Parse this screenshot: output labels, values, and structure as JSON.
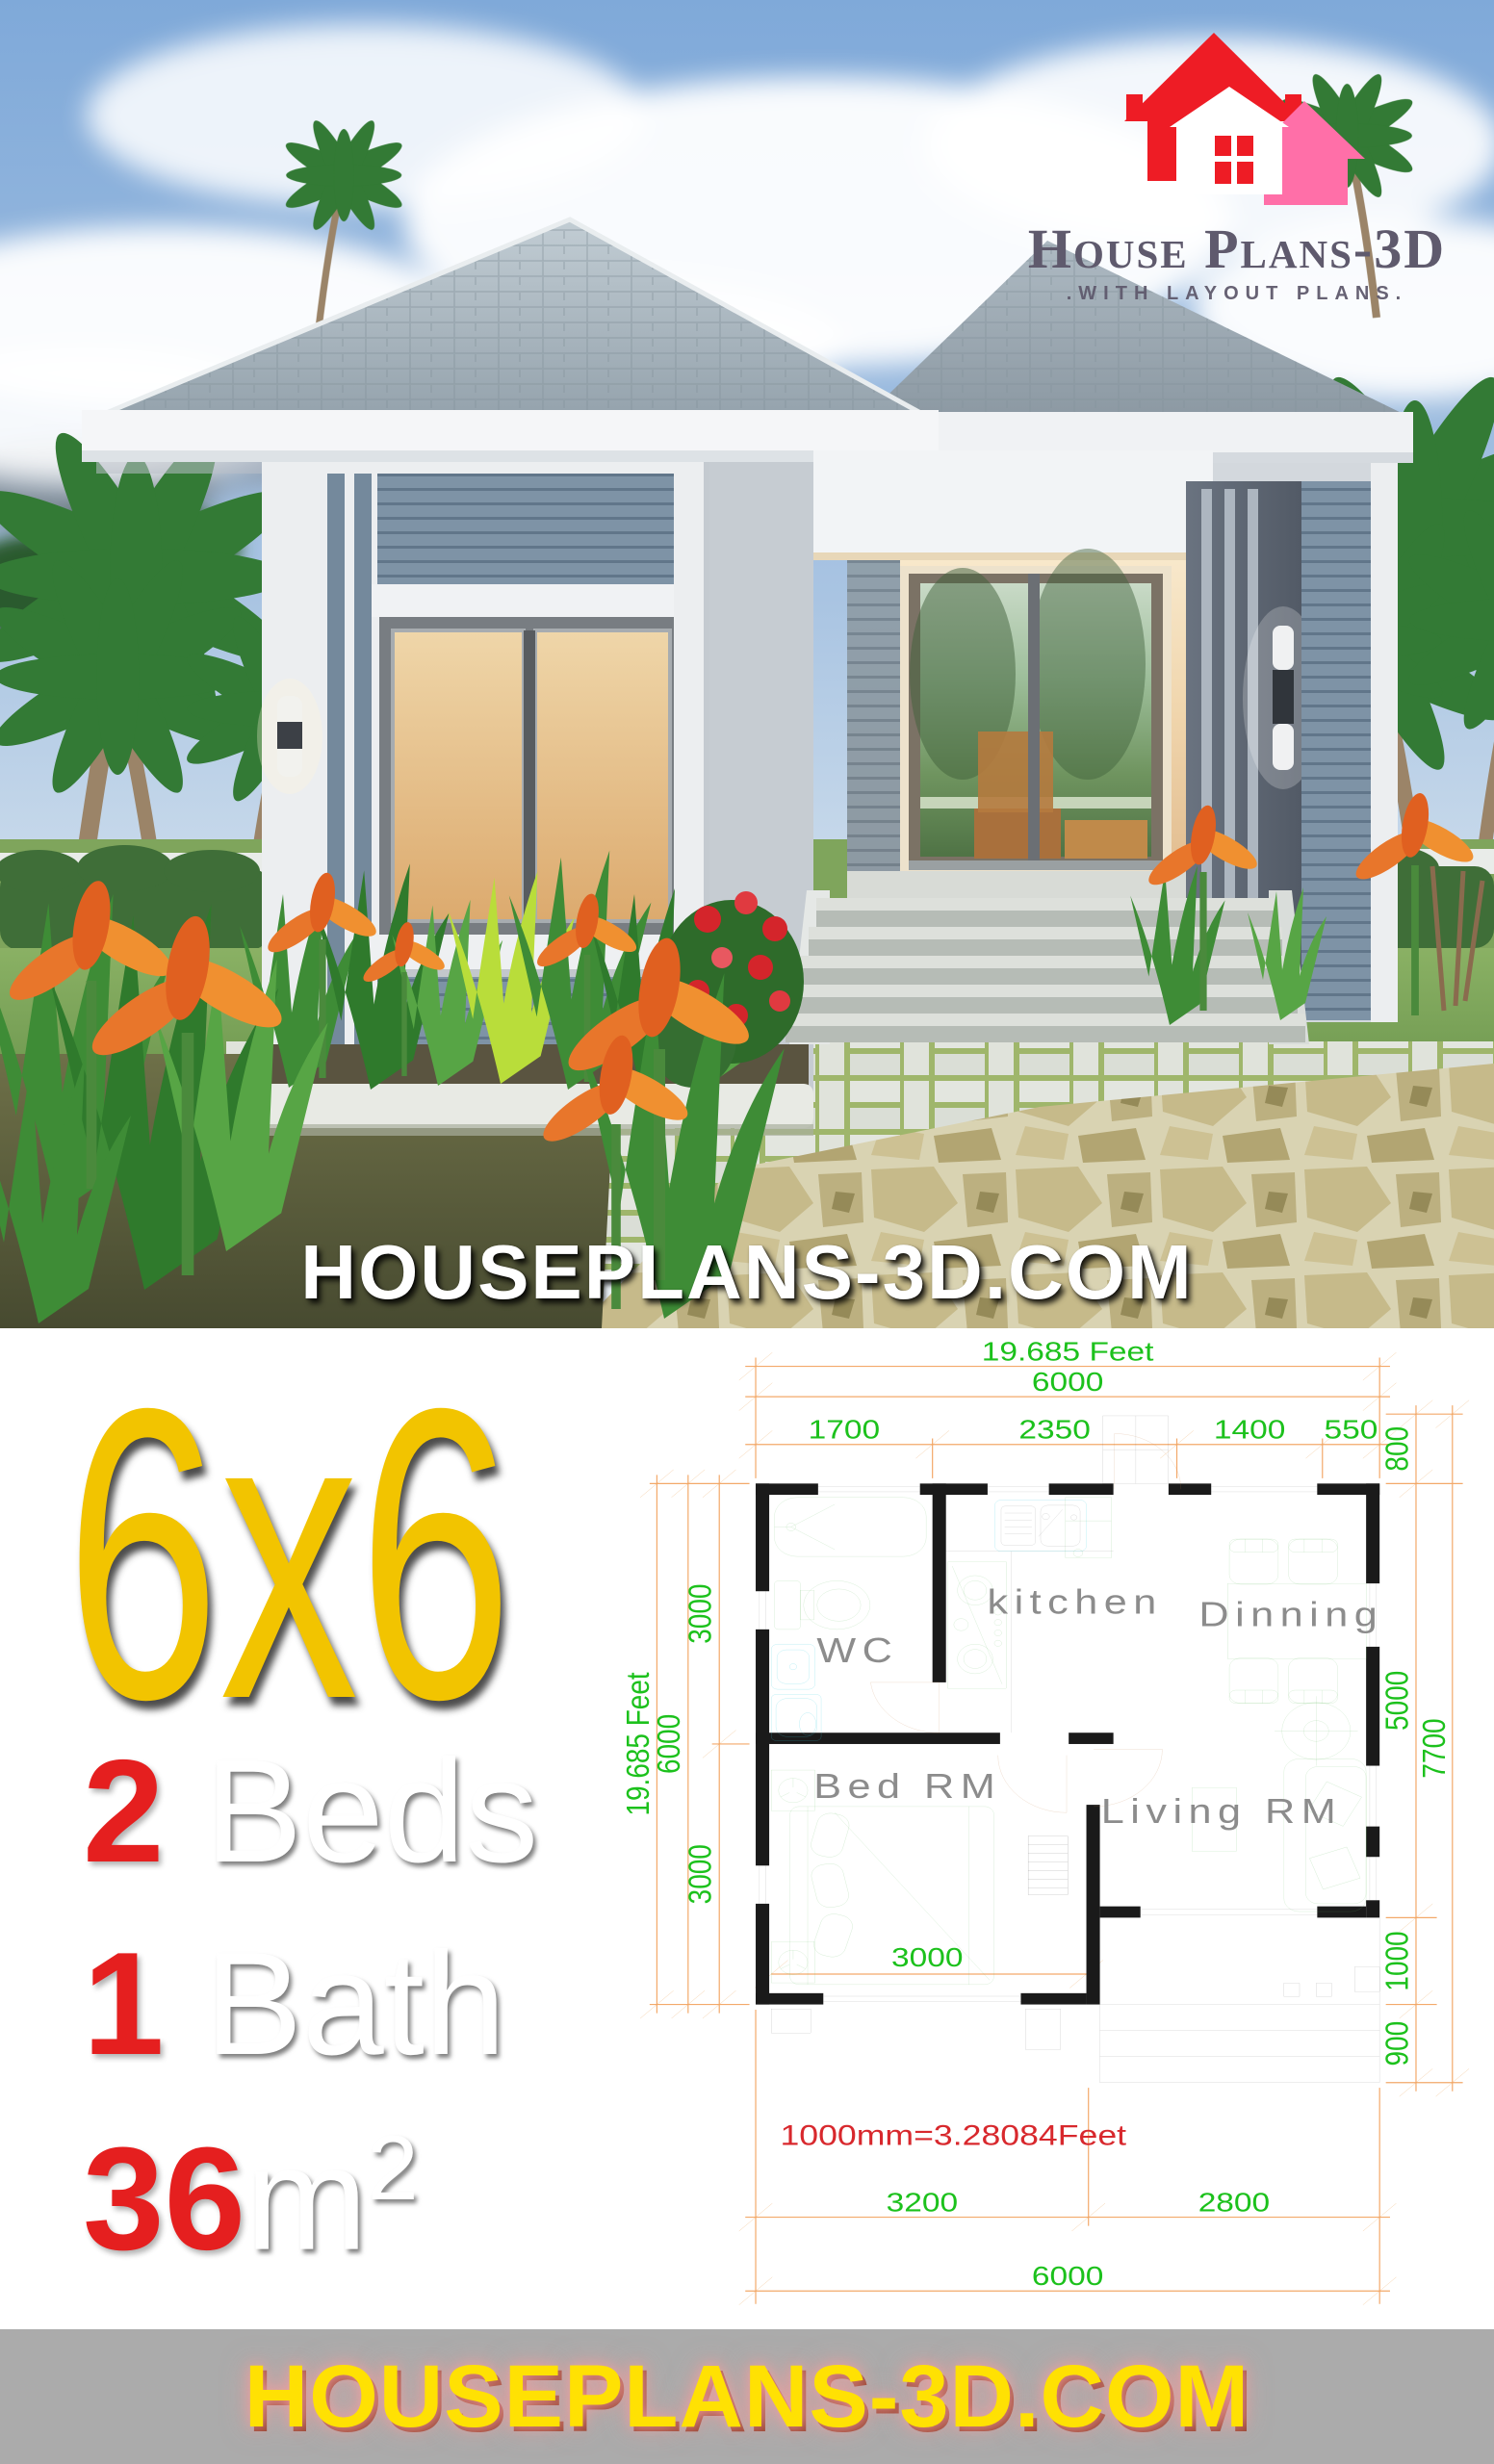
{
  "logo": {
    "title": "House Plans-3D",
    "subtitle": ".WITH LAYOUT PLANS.",
    "icon_red": "#EE1C25",
    "icon_pink": "#FF6FA8",
    "text_color": "#5F5A6D"
  },
  "photo": {
    "watermark": "HOUSEPLANS-3D.COM"
  },
  "info": {
    "size": "6x6",
    "beds_num": "2",
    "beds_label": "Beds",
    "bath_num": "1",
    "bath_label": "Bath",
    "area_num": "36",
    "area_unit": "m",
    "area_sup": "2"
  },
  "plan": {
    "top": {
      "feet": "19.685 Feet",
      "total": "6000",
      "seg1": "1700",
      "seg2": "2350",
      "seg3": "1400",
      "seg4": "550"
    },
    "right": {
      "stoop": "800",
      "living": "5000",
      "overall": "7700",
      "porch": "1000",
      "steps": "900"
    },
    "left": {
      "upper": "3000",
      "total": "6000",
      "lower": "3000",
      "feet": "19.685 Feet"
    },
    "bottom": {
      "room": "3000",
      "left": "3200",
      "right": "2800",
      "total": "6000"
    },
    "rooms": {
      "wc": "WC",
      "kitchen": "kitchen",
      "dining": "Dinning",
      "bed": "Bed RM",
      "living": "Living RM"
    },
    "note": "1000mm=3.28084Feet"
  },
  "footer": {
    "text": "HOUSEPLANS-3D.COM"
  },
  "colors": {
    "accent_yellow": "#F2C400",
    "accent_red": "#E51F1F",
    "dim_green": "#1CC11C",
    "dim_orange": "#F3A96A",
    "fixture_green": "#6CBF69",
    "fixture_cyan": "#3ECFE0",
    "door_brown": "#C07A45",
    "footer_bg": "#ABABAB",
    "footer_yellow": "#FFE103",
    "sky_blue": "#7FA9D9",
    "roof_gray": "#9AA7B0",
    "siding_blue": "#7E93A6",
    "glass_amber": "#E2B377"
  }
}
